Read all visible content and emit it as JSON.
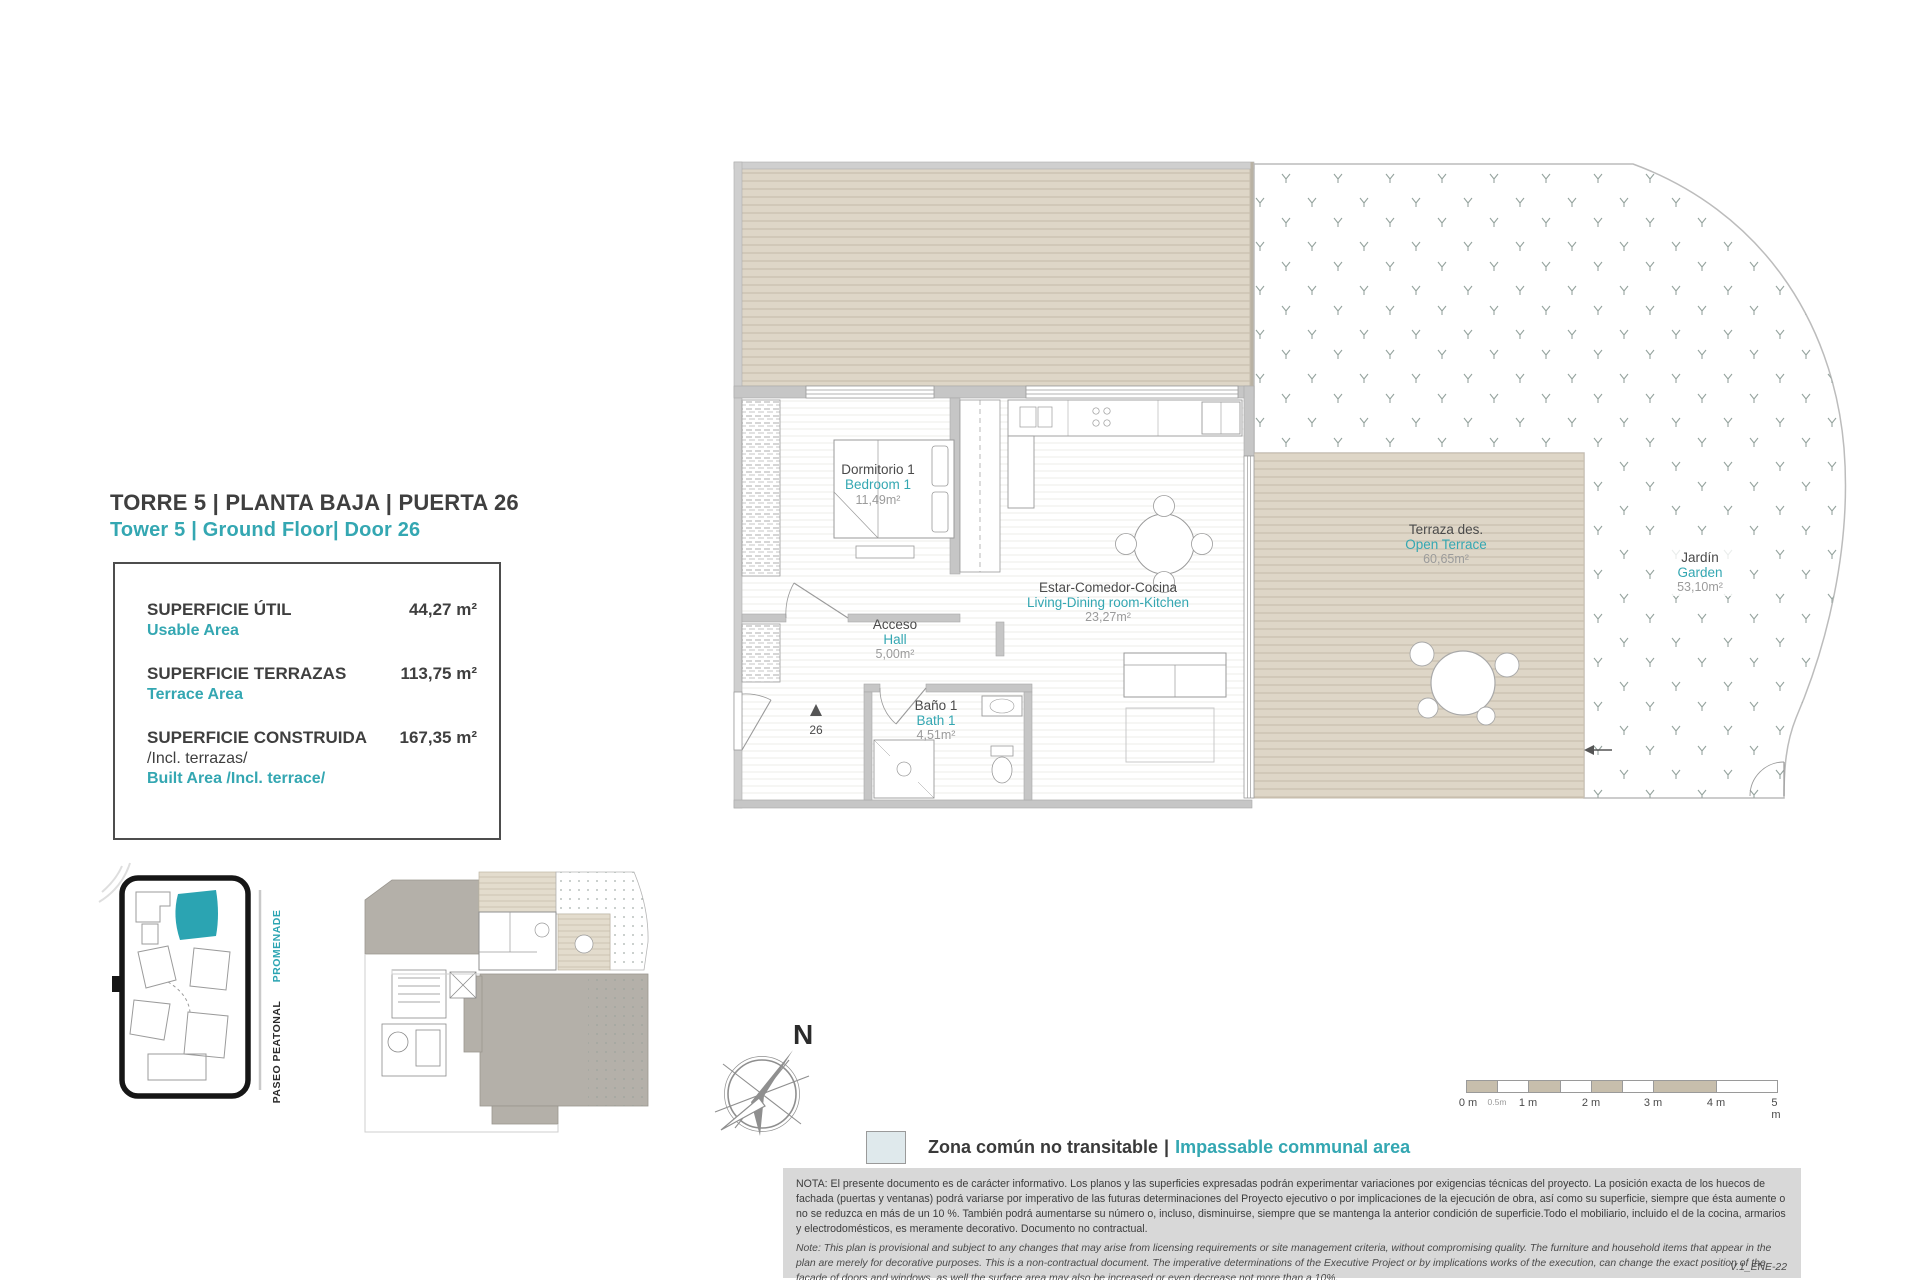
{
  "accent": "#34a7b2",
  "header": {
    "title_es": "TORRE 5 | PLANTA BAJA | PUERTA 26",
    "title_en": "Tower 5 | Ground Floor| Door 26"
  },
  "summary": {
    "rows": [
      {
        "label_es": "SUPERFICIE ÚTIL",
        "label_es2": "",
        "label_en": "Usable Area",
        "value": "44,27 m²"
      },
      {
        "label_es": "SUPERFICIE TERRAZAS",
        "label_es2": "",
        "label_en": "Terrace Area",
        "value": "113,75 m²"
      },
      {
        "label_es": "SUPERFICIE CONSTRUIDA",
        "label_es2": "/Incl. terrazas/",
        "label_en": "Built Area /Incl. terrace/",
        "value": "167,35 m²"
      }
    ]
  },
  "plan": {
    "rooms": [
      {
        "es": "Dormitorio 1",
        "en": "Bedroom 1",
        "area": "11,49m²"
      },
      {
        "es": "Acceso",
        "en": "Hall",
        "area": "5,00m²"
      },
      {
        "es": "Baño 1",
        "en": "Bath 1",
        "area": "4,51m²"
      },
      {
        "es": "Estar-Comedor-Cocina",
        "en": "Living-Dining room-Kitchen",
        "area": "23,27m²"
      },
      {
        "es": "Terraza des.",
        "en": "Open Terrace",
        "area": "60,65m²"
      },
      {
        "es": "Jardín",
        "en": "Garden",
        "area": "53,10m²"
      }
    ],
    "entrance_number": "26",
    "compass_letter": "N",
    "deck_color": "#ded6c7"
  },
  "sitemap": {
    "promenade": "PROMENADE",
    "paseo": "PASEO PEATONAL"
  },
  "legend": {
    "label_es": "Zona común no transitable",
    "separator": "|",
    "label_en": "Impassable communal area",
    "swatch_color": "#dfe9ec"
  },
  "scalebar": {
    "labels": [
      "0 m",
      "0.5m",
      "1 m",
      "2 m",
      "3 m",
      "4 m",
      "5 m"
    ]
  },
  "notes": {
    "nota_es": "NOTA:  El presente documento es de carácter informativo. Los planos y las superficies expresadas podrán experimentar variaciones por exigencias técnicas del proyecto. La posición exacta de los huecos de fachada (puertas y ventanas) podrá variarse por imperativo de las futuras determinaciones del Proyecto ejecutivo o por implicaciones de la ejecución de obra, así como su superficie, siempre que ésta aumente o no se reduzca en más de un 10 %. También podrá aumentarse su número o, incluso, disminuirse, siempre que se mantenga la anterior condición de superficie.Todo el mobiliario, incluido el de la cocina, armarios y electrodomésticos, es meramente decorativo. Documento no contractual.",
    "note_en": "Note: This plan is provisional and subject to any changes that may arise from licensing requirements or site management criteria, without compromising quality. The furniture and household items that appear in the plan are merely for decorative purposes. This is a non-contractual document. The imperative determinations of the Executive Project or by implications works of the execution, can change the exact position of the facade of doors and windows, as well the surface area may also be increased or even decrease not more than a 10%.",
    "version": "V.1_ENE-22"
  }
}
